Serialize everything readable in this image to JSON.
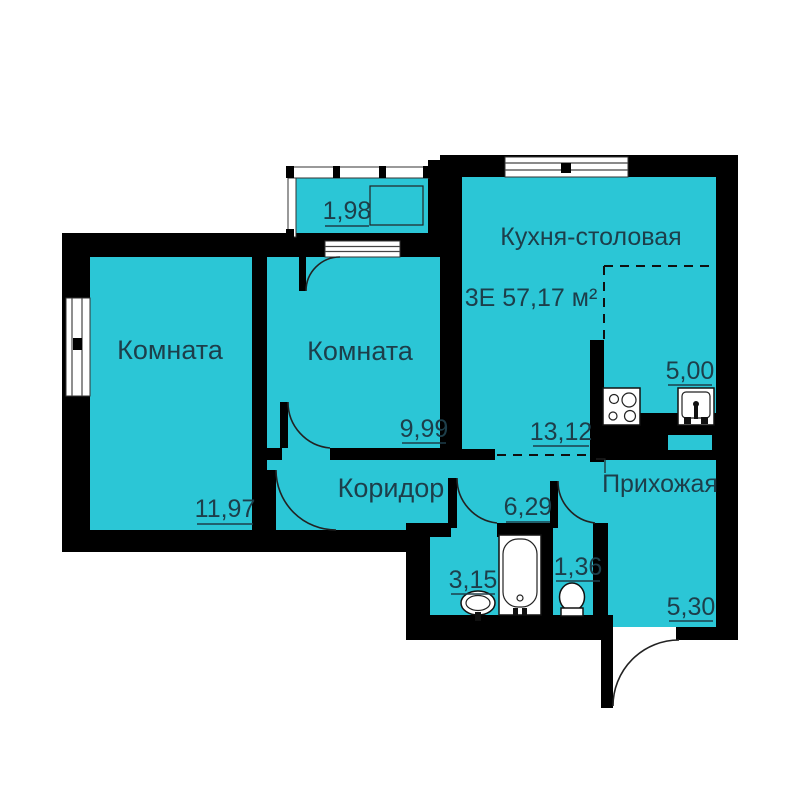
{
  "apartment": {
    "title": "3Е 57,17 м²"
  },
  "rooms": {
    "kitchen": {
      "label": "Кухня-столовая",
      "area": "13,12"
    },
    "kitchen_zone": {
      "label": "",
      "area": "5,00"
    },
    "room_left": {
      "label": "Комната",
      "area": "11,97"
    },
    "room_mid": {
      "label": "Комната",
      "area": "9,99"
    },
    "corridor": {
      "label": "Коридор",
      "area": "6,29"
    },
    "hallway": {
      "label": "Прихожая",
      "area": "5,30"
    },
    "bathroom": {
      "label": "",
      "area": "3,15"
    },
    "toilet": {
      "label": "",
      "area": "1,36"
    },
    "balcony": {
      "label": "",
      "area": "1,98"
    }
  },
  "icons": [
    "stove-icon",
    "kitchen-sink-icon",
    "bathtub-icon",
    "washbasin-icon",
    "toilet-icon",
    "entry-door-icon",
    "balcony-glazing-icon",
    "window-icon"
  ],
  "colors": {
    "floor": "#2bc6d6",
    "wall": "#000000",
    "label_text": "#1d3e4a",
    "background": "#ffffff"
  }
}
